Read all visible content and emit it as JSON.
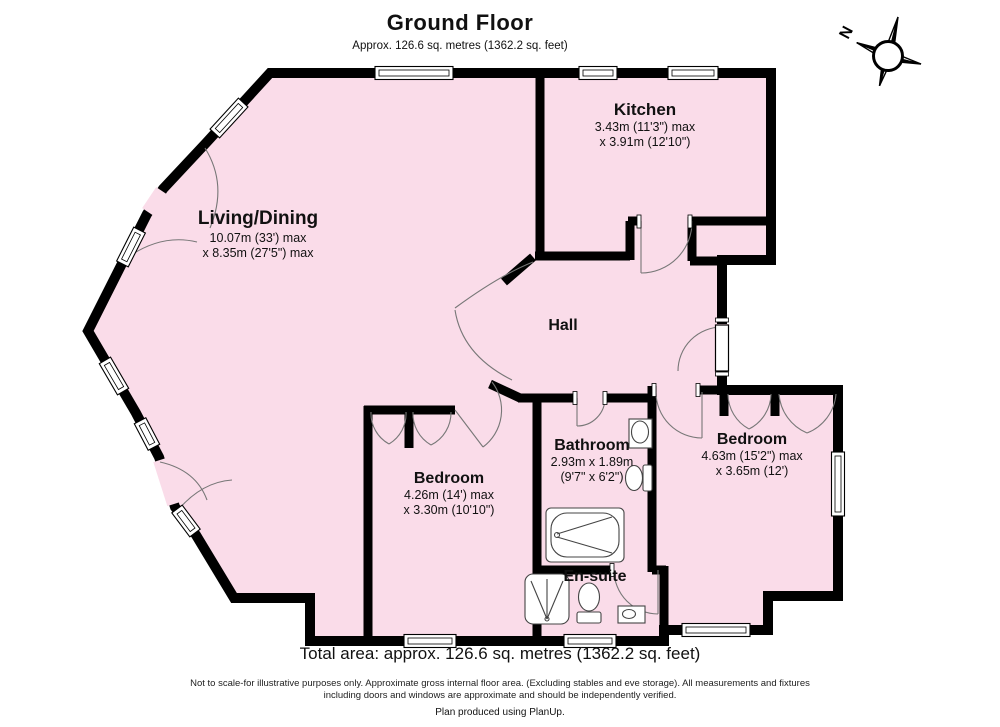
{
  "header": {
    "title": "Ground Floor",
    "subtitle": "Approx. 126.6 sq. metres (1362.2 sq. feet)"
  },
  "compass": {
    "label": "N"
  },
  "rooms": {
    "kitchen": {
      "name": "Kitchen",
      "dim1": "3.43m (11'3\") max",
      "dim2": "x 3.91m (12'10\")"
    },
    "living": {
      "name": "Living/Dining",
      "dim1": "10.07m (33') max",
      "dim2": "x 8.35m (27'5\") max"
    },
    "hall": {
      "name": "Hall"
    },
    "bathroom": {
      "name": "Bathroom",
      "dim1": "2.93m x 1.89m",
      "dim2": "(9'7\" x 6'2\")"
    },
    "bedroom_right": {
      "name": "Bedroom",
      "dim1": "4.63m (15'2\") max",
      "dim2": "x 3.65m (12')"
    },
    "bedroom_left": {
      "name": "Bedroom",
      "dim1": "4.26m (14') max",
      "dim2": "x 3.30m (10'10\")"
    },
    "ensuite": {
      "name": "En-suite"
    }
  },
  "footer": {
    "total": "Total area: approx. 126.6 sq. metres (1362.2 sq. feet)",
    "disclaimer1": "Not to scale-for illustrative purposes only. Approximate gross internal floor area. (Excluding stables and eve storage). All measurements and fixtures",
    "disclaimer2": "including doors and windows are approximate and should be independently verified.",
    "credit": "Plan produced using PlanUp."
  },
  "colors": {
    "floor": "#fadce9",
    "wall": "#000000",
    "arc": "#777777"
  }
}
